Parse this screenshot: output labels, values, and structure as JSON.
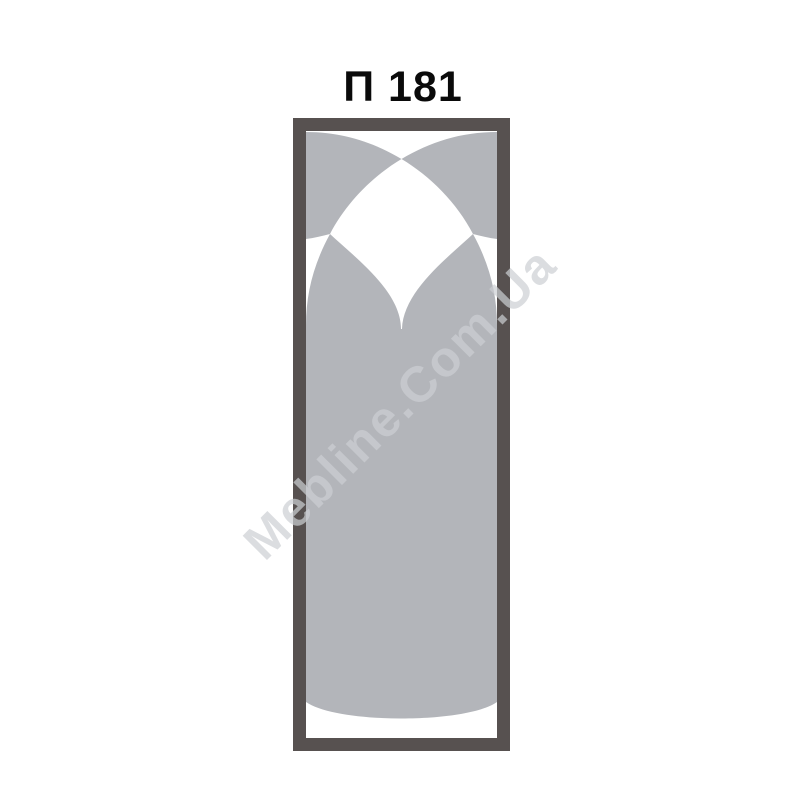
{
  "title": {
    "text": "П 181"
  },
  "watermark": {
    "text": "Mebline.Com.Ua"
  },
  "panel": {
    "name": "furniture-facade-panel",
    "pattern": "two large crossing arcs forming corner sails, twin arches meeting in a down-pointing cusp, solid column body with bulged bottom arc"
  },
  "colors": {
    "background": "#ffffff",
    "frame": "#575150",
    "panel_background": "#ffffff",
    "panel_fill": "#b3b5ba",
    "title_text": "#0a0a0a",
    "watermark_text": "#cdd0d4"
  }
}
